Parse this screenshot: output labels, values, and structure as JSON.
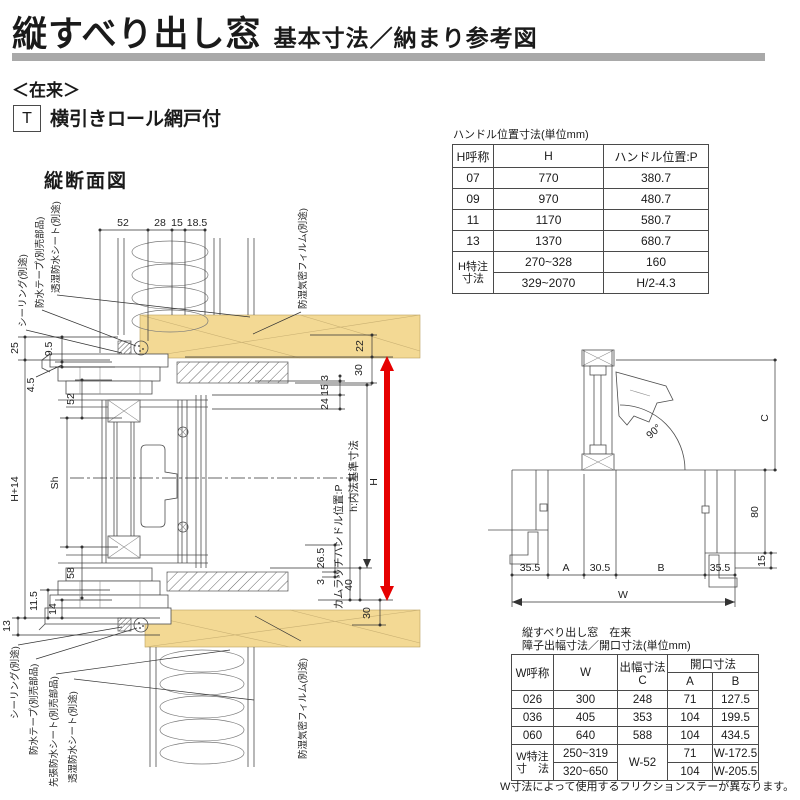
{
  "page": {
    "title": "縦すべり出し窓",
    "subtitle": "基本寸法／納まり参考図",
    "system_label": "＜在来＞",
    "type_code": "T",
    "type_label": "横引きロール網戸付",
    "section_title": "縦断面図"
  },
  "colors": {
    "accent_red": "#e60000",
    "wood_tan": "#f3d994",
    "divider_gray": "#a9a9a9"
  },
  "vertical_section": {
    "top_dims": {
      "d52": "52",
      "d28": "28",
      "d15": "15",
      "d18_5": "18.5"
    },
    "left_dims": {
      "d25": "25",
      "d9_5": "9.5",
      "d4_5": "4.5",
      "d52": "52",
      "dh14": "H+14",
      "dsh": "Sh",
      "d58": "58",
      "d11_5": "11.5",
      "d14": "14",
      "d13": "13"
    },
    "right_dims": {
      "d22": "22",
      "d30_top": "30",
      "d3_top": "3",
      "d15": "15",
      "d24": "24",
      "d26_5": "26.5",
      "d3_bottom": "3",
      "d40": "40",
      "d30_bottom": "30",
      "dH": "H"
    },
    "axis_labels": {
      "inner_height": "h:内法基準寸法",
      "cam_latch": "カムラッチハンドル位置:P"
    },
    "callouts": {
      "sealing_top": "シーリング(別途)",
      "tape_top": "防水テープ(別売部品)",
      "sheet_top": "透湿防水シート(別途)",
      "film_top": "防湿気密フィルム(別途)",
      "sealing_bottom": "シーリング(別途)",
      "tape_bottom": "防水テープ(別売部品)",
      "pre_sheet_bottom": "先張防水シート(別売部品)",
      "sheet_bottom": "透湿防水シート(別途)",
      "film_bottom": "防湿気密フィルム(別途)"
    }
  },
  "plan_view": {
    "angle": "90°",
    "dim_c": "C",
    "d80": "80",
    "d15": "15",
    "d35_5_left": "35.5",
    "dA": "A",
    "d30_5": "30.5",
    "dB": "B",
    "d35_5_right": "35.5",
    "dW": "W"
  },
  "handle_table": {
    "title": "ハンドル位置寸法(単位mm)",
    "col_h_name": "H呼称",
    "col_h": "H",
    "col_p": "ハンドル位置:P",
    "rows": [
      {
        "name": "07",
        "h": "770",
        "p": "380.7"
      },
      {
        "name": "09",
        "h": "970",
        "p": "480.7"
      },
      {
        "name": "11",
        "h": "1170",
        "p": "580.7"
      },
      {
        "name": "13",
        "h": "1370",
        "p": "680.7"
      }
    ],
    "custom_label_1": "H特注",
    "custom_label_2": "寸法",
    "custom_rows": [
      {
        "h": "270~328",
        "p": "160"
      },
      {
        "h": "329~2070",
        "p": "H/2-4.3"
      }
    ]
  },
  "width_table": {
    "title_1": "縦すべり出し窓　在来",
    "title_2": "障子出幅寸法／開口寸法(単位mm)",
    "col_w_name": "W呼称",
    "col_w": "W",
    "col_c": "出幅寸法C",
    "col_opening": "開口寸法",
    "col_a": "A",
    "col_b": "B",
    "rows": [
      {
        "name": "026",
        "w": "300",
        "c": "248",
        "a": "71",
        "b": "127.5"
      },
      {
        "name": "036",
        "w": "405",
        "c": "353",
        "a": "104",
        "b": "199.5"
      },
      {
        "name": "060",
        "w": "640",
        "c": "588",
        "a": "104",
        "b": "434.5"
      }
    ],
    "custom_label_1": "W特注",
    "custom_label_2": "寸　法",
    "custom_w_1": "250~319",
    "custom_w_2": "320~650",
    "custom_c": "W-52",
    "custom_rows": [
      {
        "a": "71",
        "b": "W-172.5"
      },
      {
        "a": "104",
        "b": "W-205.5"
      }
    ],
    "note": "W寸法によって使用するフリクションステーが異なります。"
  }
}
